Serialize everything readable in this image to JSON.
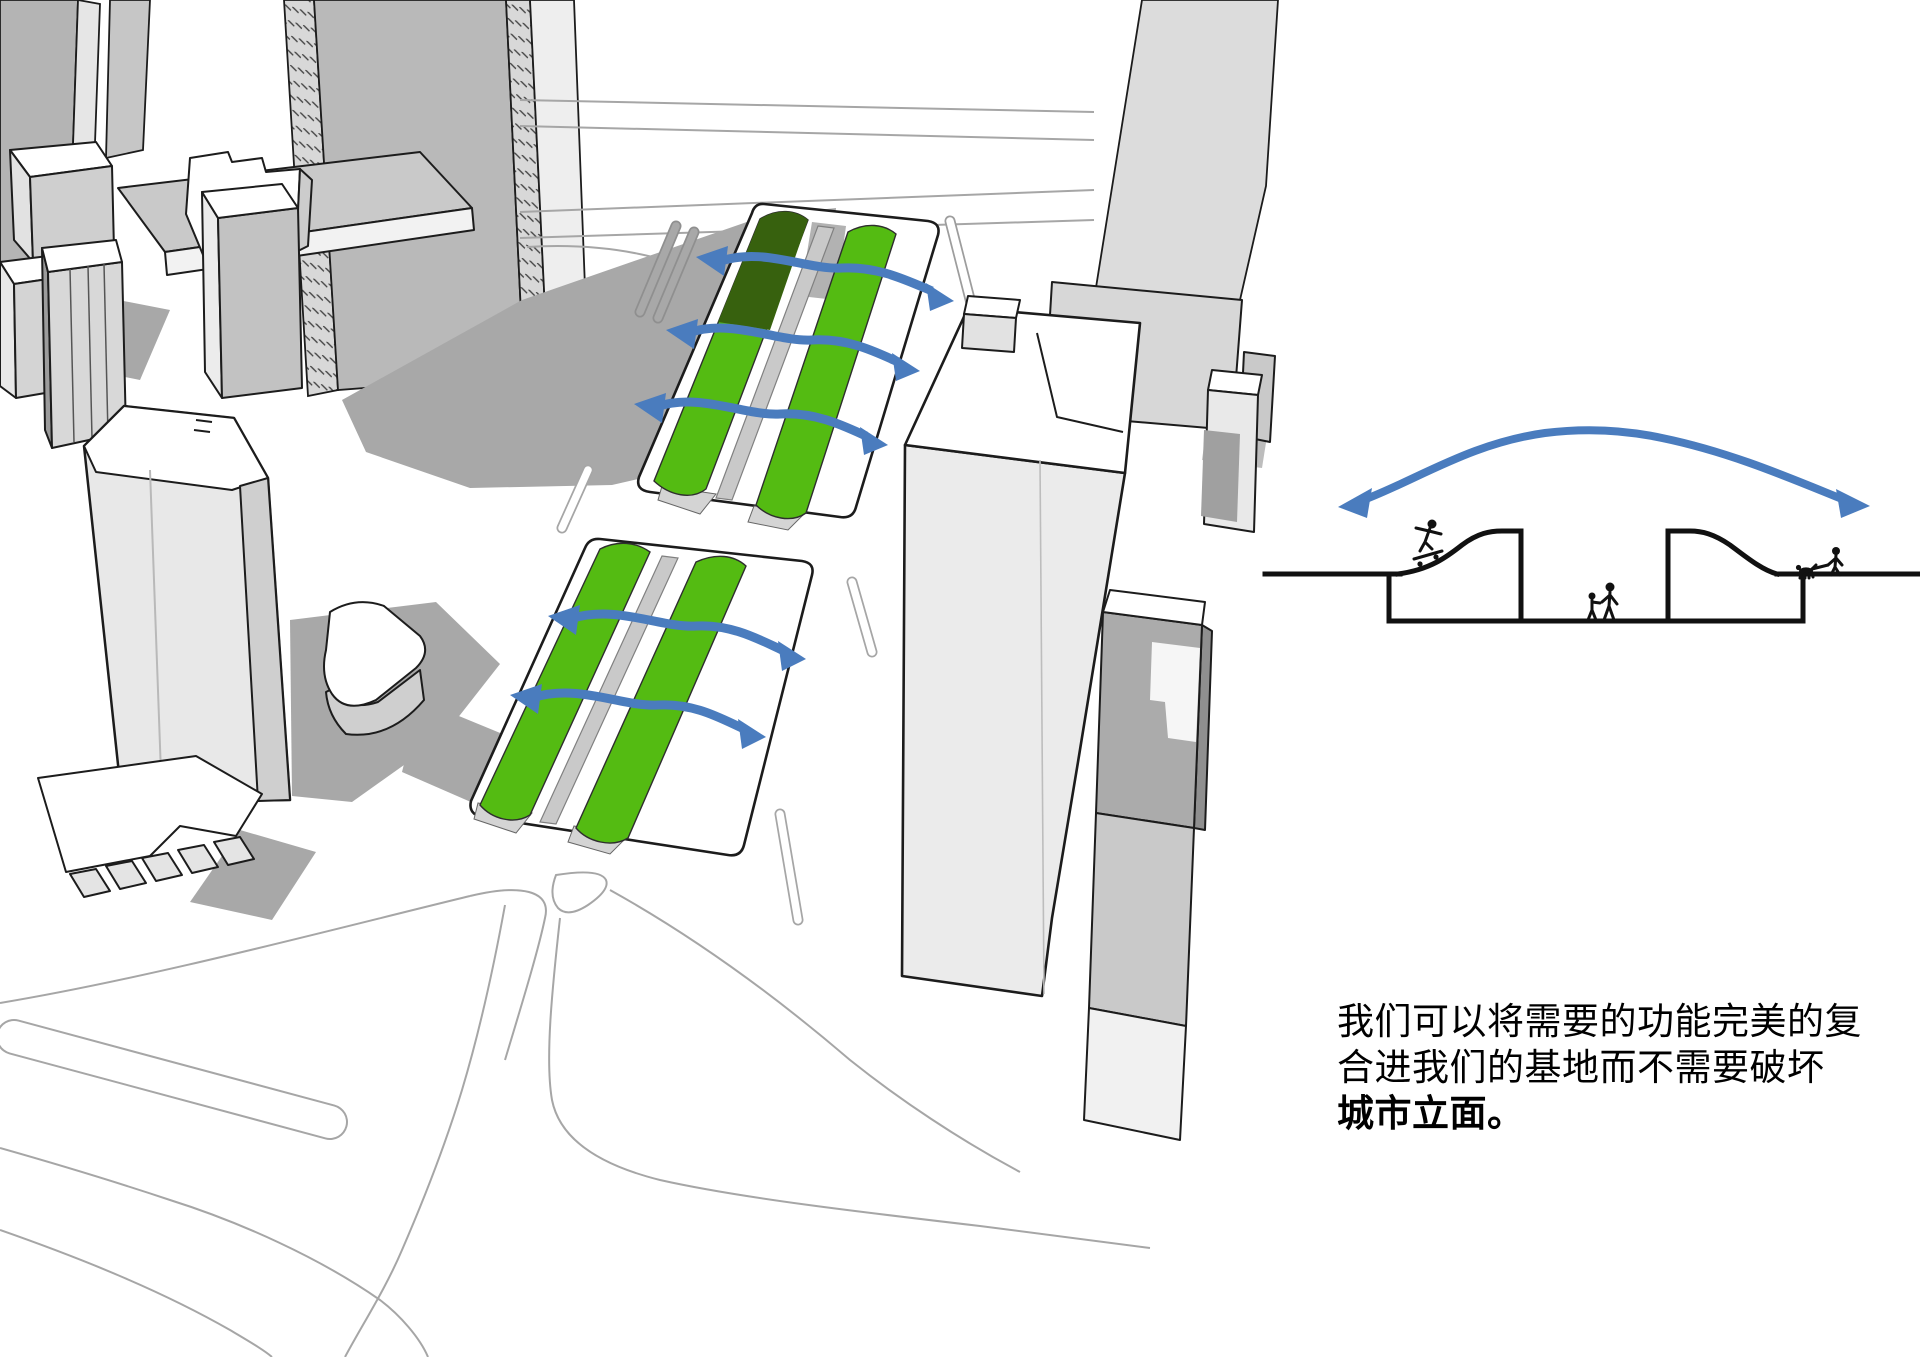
{
  "page": {
    "width": 1920,
    "height": 1357,
    "background": "#ffffff"
  },
  "colors": {
    "grass_green": "#54bb12",
    "grass_green_shadow": "#37610e",
    "flow_arrow_blue": "#4a7cbe",
    "ink_outline": "#1c1c1c",
    "ground_shadow": "#a8a8a8",
    "road_line_gray": "#a6a6a6",
    "massing_white": "#ffffff",
    "massing_light": "#ececec",
    "massing_mid": "#c9c9c9",
    "massing_dark": "#9e9e9e"
  },
  "axon_diagram": {
    "green_parcels": 2,
    "flow_arrows_upper_parcel": 3,
    "flow_arrows_lower_parcel": 2
  },
  "section_diagram": {
    "airflow_arrow_heads": 2,
    "figures": [
      "skateboarder",
      "adult-and-child",
      "dog-walker"
    ]
  },
  "caption": {
    "line1": "我们可以将需要的功能完美的复",
    "line2": "合进我们的基地而不需要破坏",
    "line3": "城市立面。"
  }
}
